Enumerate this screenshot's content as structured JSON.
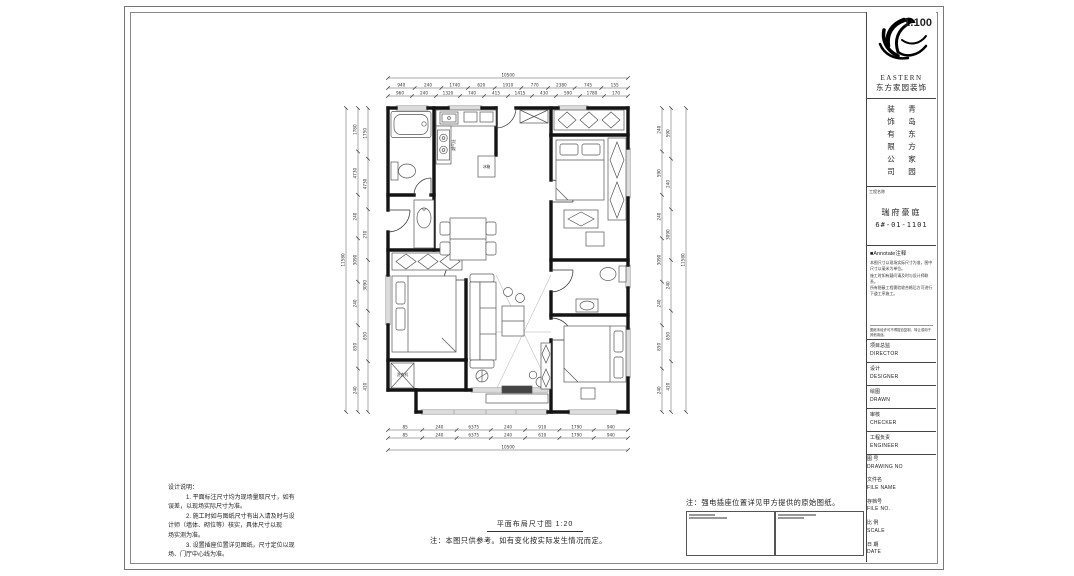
{
  "title_block": {
    "logo": {
      "brand": "EASTERN",
      "brand_cn": "东方家园装饰"
    },
    "company_vertical": {
      "col_left": "装饰有限公司",
      "col_right": "青岛东方家园"
    },
    "project": {
      "label": "工程名称",
      "name": "瑞府豪庭",
      "unit": "6#-01-1101"
    },
    "annotate": {
      "header": "■Annotate注释",
      "lines": [
        "本图尺寸以现场实际尺寸为准，图中",
        "尺寸以毫米为单位。",
        "施工时如有疑问请及时与设计师联系。",
        "所有隐蔽工程需验收合格后方可进行",
        "下道工序施工。"
      ],
      "footer": "图纸未经许可不得擅自复制、转让或用于其他用途。"
    },
    "fields": [
      {
        "cn": "项目总监",
        "en": "DIRECTOR"
      },
      {
        "cn": "设计",
        "en": "DESIGNER"
      },
      {
        "cn": "绘图",
        "en": "DRAWN"
      },
      {
        "cn": "审核",
        "en": "CHECKER"
      },
      {
        "cn": "工程负责",
        "en": "ENGINEER"
      }
    ],
    "file_fields": [
      {
        "cn": "图 号",
        "en": "DRAWING NO",
        "value": ""
      },
      {
        "cn": "文件名",
        "en": "FILE NAME",
        "value": ""
      },
      {
        "cn": "存档号",
        "en": "FILE NO.",
        "value": ""
      },
      {
        "cn": "比 例",
        "en": "SCALE",
        "value": "1:100"
      },
      {
        "cn": "日 期",
        "en": "DATE",
        "value": ""
      }
    ]
  },
  "plan": {
    "caption": "平面布局尺寸图 1:20",
    "caption_note": "注：本图只供参考。如有变化按实际发生情况而定。",
    "side_note": "注：强电插座位置详见甲方提供的原始图纸。",
    "furniture_labels": {
      "fridge": "冰箱",
      "stove": "燃气灶",
      "washer": "洗衣机"
    },
    "dimensions": {
      "top": {
        "total": "10500",
        "rows": [
          [
            "940",
            "240",
            "1740",
            "620",
            "1910",
            "770",
            "2380",
            "745",
            "155"
          ],
          [
            "960",
            "240",
            "1320",
            "740",
            "415",
            "1415",
            "430",
            "590",
            "1780",
            "170"
          ]
        ]
      },
      "bottom": {
        "total": "10500",
        "rows": [
          [
            "85",
            "240",
            "6375",
            "240",
            "910",
            "1790",
            "940"
          ],
          [
            "85",
            "240",
            "6375",
            "240",
            "610",
            "1790",
            "940"
          ]
        ]
      },
      "left": {
        "total": "11580",
        "rows": [
          [
            "1780",
            "4730",
            "240",
            "3090",
            "240",
            "850",
            "240"
          ],
          [
            "1750",
            "4730",
            "270",
            "3090",
            "850",
            "410"
          ]
        ]
      },
      "right": {
        "total": "11580",
        "rows": [
          [
            "240",
            "590",
            "240",
            "3090",
            "240",
            "850",
            "240"
          ],
          [
            "590",
            "240",
            "3090",
            "240",
            "850",
            "410"
          ]
        ]
      }
    }
  },
  "design_notes": {
    "title": "设计说明：",
    "lines": [
      "1. 平面标注尺寸均为现场量取尺寸，如有",
      "误差，以现场实际尺寸为准。",
      "2. 施工时如与图纸尺寸有出入请及时与设",
      "计师（墙体、砌位等）核实，具体尺寸以现",
      "场实测为准。",
      "3. 设置插座位置详见图纸，尺寸定位以现",
      "场、门厅中心线为准。"
    ]
  }
}
